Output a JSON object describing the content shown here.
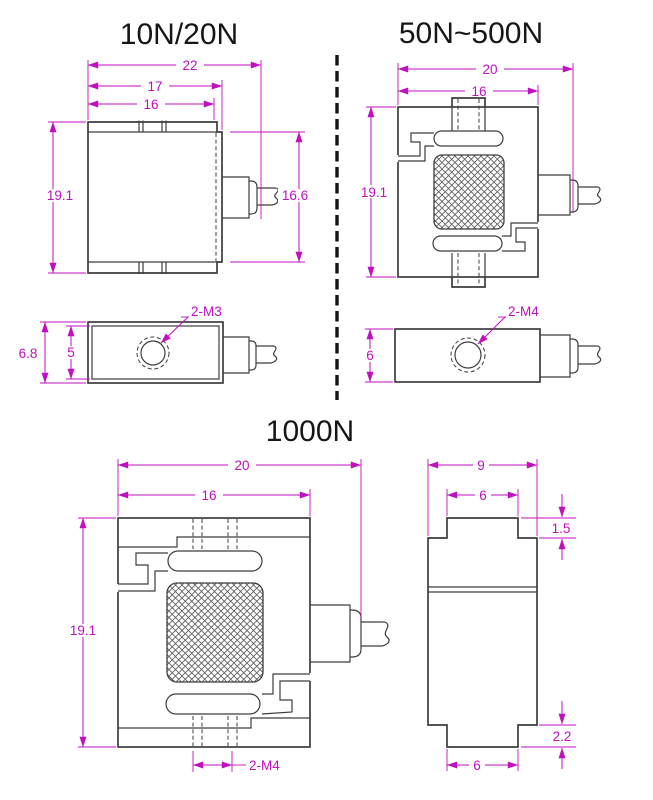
{
  "colors": {
    "dimension": "#c010c0",
    "drawing_line": "#3d3d3d",
    "background": "#ffffff",
    "title_text": "#161616"
  },
  "views": {
    "v10_20": {
      "title": "10N/20N",
      "front": {
        "width_overall": "22",
        "width_body": "17",
        "width_plate": "16",
        "height_overall": "19.1",
        "height_mid": "16.6"
      },
      "side": {
        "height_outer": "6.8",
        "height_inner": "5",
        "thread": "2-M3"
      }
    },
    "v50_500": {
      "title": "50N~500N",
      "front": {
        "width_overall": "20",
        "width_body": "16",
        "height_overall": "19.1"
      },
      "side": {
        "height": "6",
        "thread": "2-M4"
      }
    },
    "v1000": {
      "title": "1000N",
      "front": {
        "width_overall": "20",
        "width_body": "16",
        "height_overall": "19.1",
        "thread": "2-M4"
      },
      "side": {
        "width_overall": "9",
        "width_boss_top": "6",
        "height_boss_top": "1.5",
        "height_boss_bottom": "2.2",
        "width_boss_bottom": "6"
      }
    }
  }
}
